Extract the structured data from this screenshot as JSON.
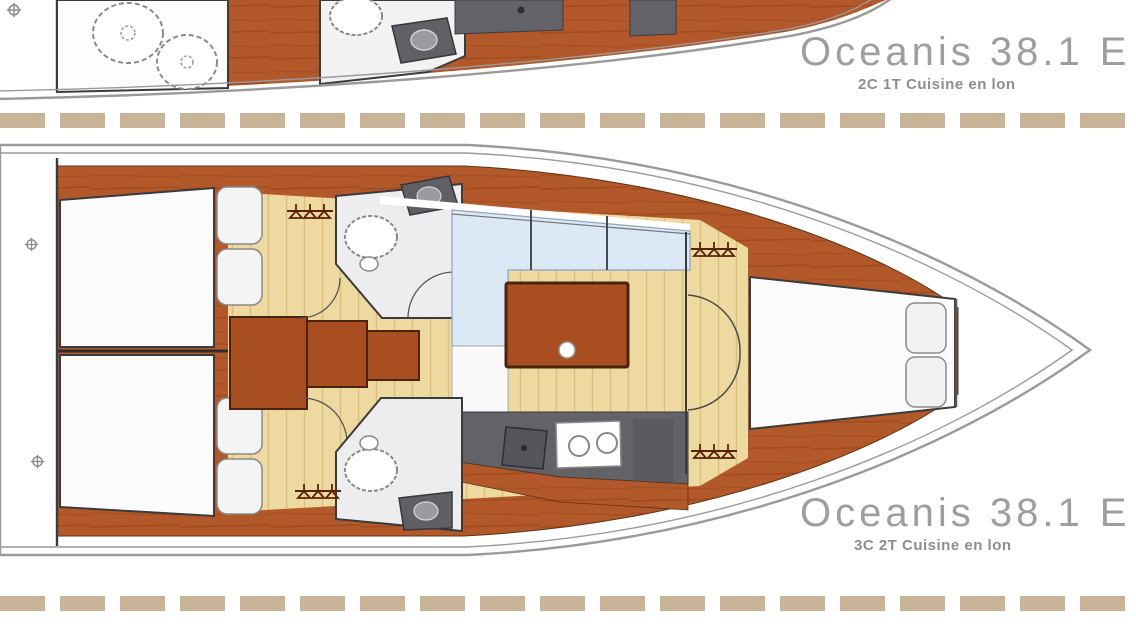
{
  "palette": {
    "wood": "#b2582a",
    "wood2": "#8d3c12",
    "table": "#a84e20",
    "tableedge": "#4a2410",
    "floor": "#eed9a0",
    "floorline": "#d9bf7e",
    "settee": "#dbe8f6",
    "counter": "#636268",
    "counter2": "#55555a",
    "head": "#ededf0",
    "hull": "#9a9a9a",
    "line": "#3b3b3b",
    "dash": "#cab497",
    "title": "#9e9e9e",
    "subtitle": "#8e8e8e",
    "hanger": "#5a2208",
    "white": "#ffffff"
  },
  "boats": {
    "top": {
      "title": "Oceanis 38.1",
      "suffix": "E",
      "subtitle": "2C 1T Cuisine en lon"
    },
    "bottom": {
      "title": "Oceanis 38.1",
      "suffix": "E",
      "subtitle": "3C 2T Cuisine en lon"
    }
  }
}
